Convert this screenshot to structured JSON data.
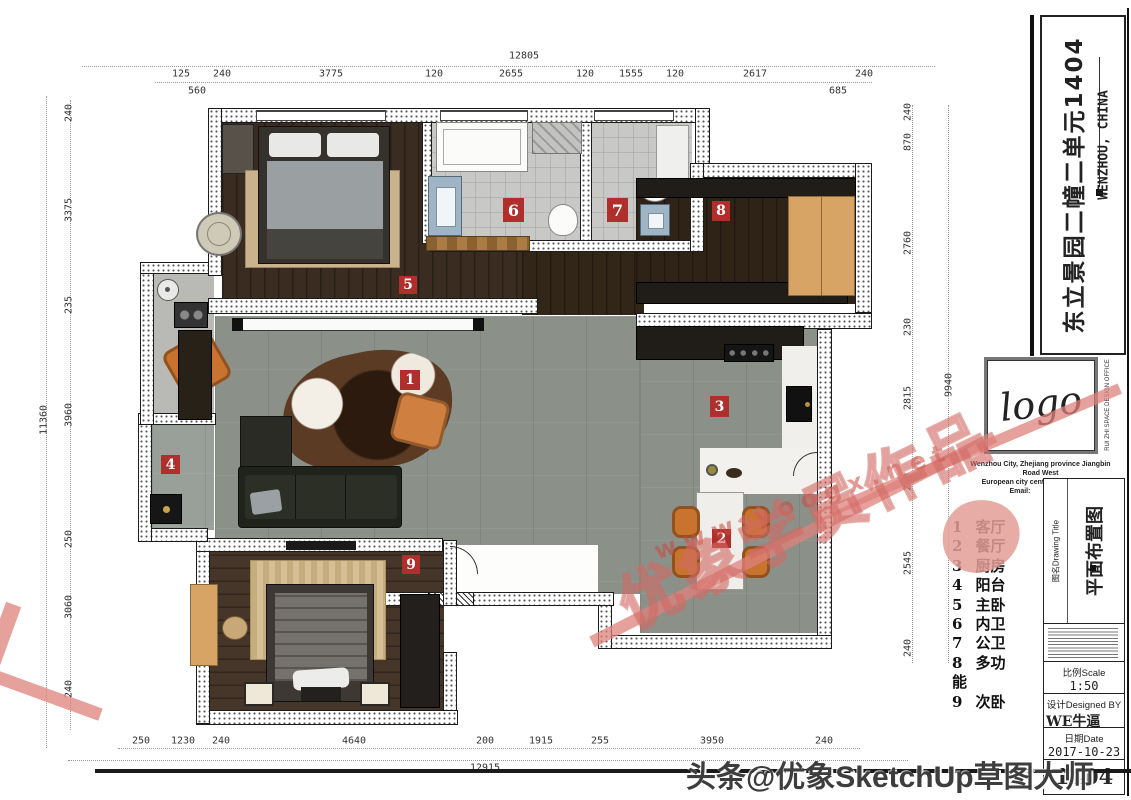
{
  "title_block": {
    "project_title": "东立景园二幢二单元1404",
    "location": "WENZHOU, CHINA",
    "logo_text": "logo",
    "office_name_vertical": "RUI ZHI SPACE DESIGN OFFICE",
    "address_line1": "Wenzhou City, Zhejiang province Jiangbin Road West",
    "address_line2": "European city center building room",
    "contact_line": "Email:               Tel:",
    "drawing_title_label": "图名Drawing Title",
    "drawing_title": "平面布置图",
    "scale_label": "比例Scale",
    "scale_value": "1:50",
    "designed_label": "设计Designed BY",
    "designed_value": "WE牛逼",
    "date_label": "日期Date",
    "date_value": "2017-10-23",
    "sheet_number": "1404"
  },
  "legend": {
    "items": [
      {
        "num": "1",
        "label": "客厅"
      },
      {
        "num": "2",
        "label": "餐厅"
      },
      {
        "num": "3",
        "label": "厨房"
      },
      {
        "num": "4",
        "label": "阳台"
      },
      {
        "num": "5",
        "label": "主卧"
      },
      {
        "num": "6",
        "label": "内卫"
      },
      {
        "num": "7",
        "label": "公卫"
      },
      {
        "num": "8",
        "label": "多功能"
      },
      {
        "num": "9",
        "label": "次卧"
      }
    ]
  },
  "room_markers": [
    "1",
    "2",
    "3",
    "4",
    "5",
    "6",
    "7",
    "8",
    "9"
  ],
  "dimensions": {
    "top": {
      "overall": "12805",
      "segments": [
        "125",
        "240",
        "3775",
        "120",
        "2655",
        "120",
        "1555",
        "120",
        "2617",
        "240"
      ],
      "sub_left": "560",
      "sub_right": "685"
    },
    "bottom": {
      "overall": "12915",
      "segments": [
        "250",
        "1230",
        "240",
        "4640",
        "200",
        "1915",
        "255",
        "3950",
        "240"
      ]
    },
    "left": {
      "overall": "11360",
      "segments": [
        "240",
        "3375",
        "235",
        "3960",
        "250",
        "3060",
        "240"
      ]
    },
    "right": {
      "overall": "9940",
      "segments": [
        "240",
        "870",
        "2760",
        "230",
        "2815",
        "240",
        "2545",
        "240"
      ]
    }
  },
  "watermarks": {
    "headline": "头条@优象SketchUp草图大师",
    "diagonal_text": "优象学员作品",
    "url": "www.yoogx.net"
  },
  "colors": {
    "marker_red": "#b02f2c",
    "wood_dark": "#3a2c21",
    "tile_gray": "#8b9189",
    "bath_tile": "#c8c8c6",
    "accent_wood": "#d7a465",
    "watermark_pink": "#d97a72"
  }
}
